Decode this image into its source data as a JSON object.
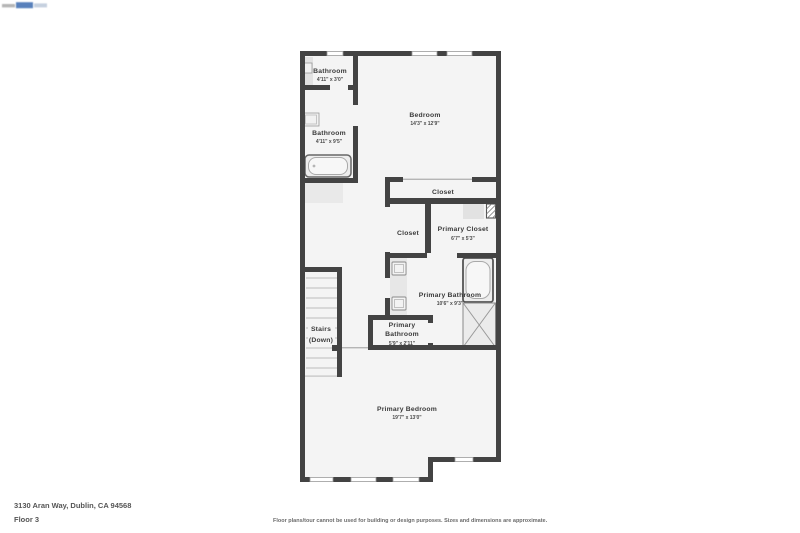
{
  "icons": {
    "logo": "brand-logo",
    "fixtures": [
      "bathtub-icon",
      "shower-icon",
      "sink-icon",
      "vanity-icon",
      "water-heater-icon",
      "stairs-treads",
      "window"
    ]
  },
  "rooms": {
    "bathroom_top": {
      "name": "Bathroom",
      "dims": "4'11\" x 3'0\""
    },
    "bathroom_mid": {
      "name": "Bathroom",
      "dims": "4'11\" x 9'5\""
    },
    "bedroom": {
      "name": "Bedroom",
      "dims": "14'3\" x 12'9\""
    },
    "closet_bedroom": {
      "name": "Closet"
    },
    "closet_hall": {
      "name": "Closet"
    },
    "primary_closet": {
      "name": "Primary Closet",
      "dims": "6'7\" x 5'3\""
    },
    "primary_bathroom": {
      "name": "Primary Bathroom",
      "dims": "10'6\" x 9'3\""
    },
    "primary_wc": {
      "name_line1": "Primary",
      "name_line2": "Bathroom",
      "dims": "5'9\" x 2'11\""
    },
    "stairs": {
      "name_line1": "Stairs",
      "name_line2": "(Down)"
    },
    "primary_bedroom": {
      "name": "Primary Bedroom",
      "dims": "19'7\" x 13'0\""
    }
  },
  "footer": {
    "address": "3130 Aran Way, Dublin, CA 94568",
    "floor_label": "Floor 3",
    "disclaimer": "Floor plans/tour cannot be used for building or design purposes. Sizes and dimensions are approximate."
  },
  "colors": {
    "wall": "#434343",
    "floor": "#f4f4f4",
    "fixture_fill": "#ededed",
    "logo_blue": "#3b6bb0"
  }
}
